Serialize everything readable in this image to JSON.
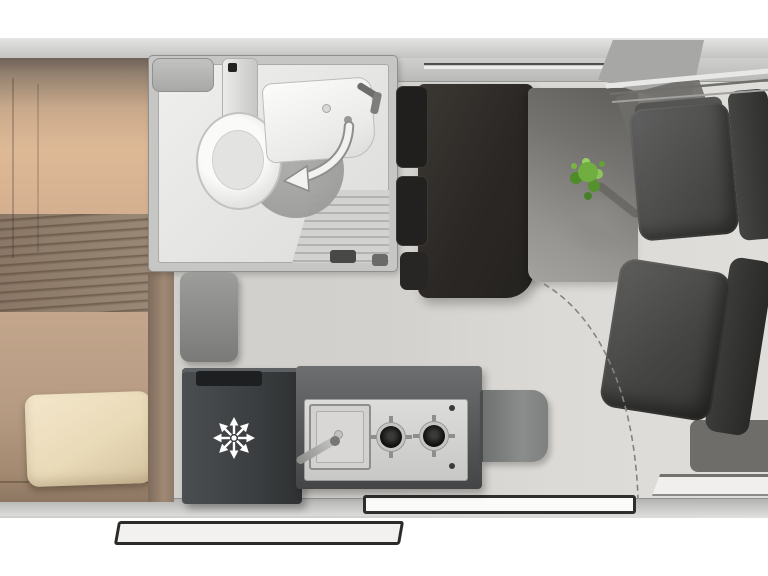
{
  "app": {
    "title": "Campervan interior floor plan, top view",
    "canvas": {
      "width": 768,
      "height": 576
    },
    "background": "#ffffff"
  },
  "palette": {
    "wall": "#c8c8c6",
    "wall_edge": "#979795",
    "floor": "#d3d1cd",
    "floor_front": "#dedcd8",
    "bed_tan": "#d7b394",
    "blanket": "#93806f",
    "blanket_streak": "#5a4a3c",
    "pillow_cream": "#eee0c2",
    "wood_trim": "#9b8472",
    "bathroom_wall": "#c6c6c4",
    "bathroom_floor": "#e9e9e7",
    "fixture_white": "#f6f6f4",
    "shower_ridge": "#b2b2b0",
    "fridge_body": "#3d4043",
    "snowflake_white": "#ffffff",
    "counter_dark": "#555758",
    "counter_top": "#d3d3d1",
    "burner_black": "#1b1b19",
    "bench_dark": "#2a2724",
    "table_gray": "#8a8884",
    "plant_green": "#6fae3f",
    "seat_gray": "#474745",
    "dash_arc": "#85837f",
    "step_outline": "#2a2a28"
  },
  "regions": {
    "bed": {
      "label": "Rear transverse bed",
      "features": [
        "mattress",
        "striped blanket",
        "cream pillow",
        "wood side board"
      ]
    },
    "bathroom": {
      "label": "Washroom",
      "features": [
        "toilet with cistern",
        "washbasin with tap",
        "ridged shower tray",
        "corner shelf",
        "folding-wall swing arrow",
        "door handle"
      ]
    },
    "kitchen": {
      "label": "Kitchenette",
      "features": [
        "refrigerator with snowflake symbol",
        "square sink with tap",
        "two-burner gas hob",
        "worktop extension flap"
      ]
    },
    "dinette": {
      "label": "Half dinette",
      "features": [
        "dark travel bench with headrests",
        "gray table",
        "green plant",
        "gray stool"
      ]
    },
    "cab": {
      "label": "Driver cab",
      "features": [
        "swivelled driver seat",
        "swivelled passenger seat",
        "dashboard shadow panel"
      ]
    },
    "shell": {
      "label": "Van body shell",
      "features": [
        "top wall with window line",
        "sliding-door opening",
        "entry step rail",
        "cab door window strip",
        "dashed door-swing arc"
      ]
    }
  },
  "icons": {
    "snowflake": {
      "name": "snowflake-icon",
      "meaning": "refrigerator",
      "color": "#ffffff",
      "arms": 8
    },
    "swing_arrow": {
      "name": "curved-arrow-icon",
      "meaning": "folding shower wall swing direction",
      "color": "#f2f2f0"
    }
  }
}
